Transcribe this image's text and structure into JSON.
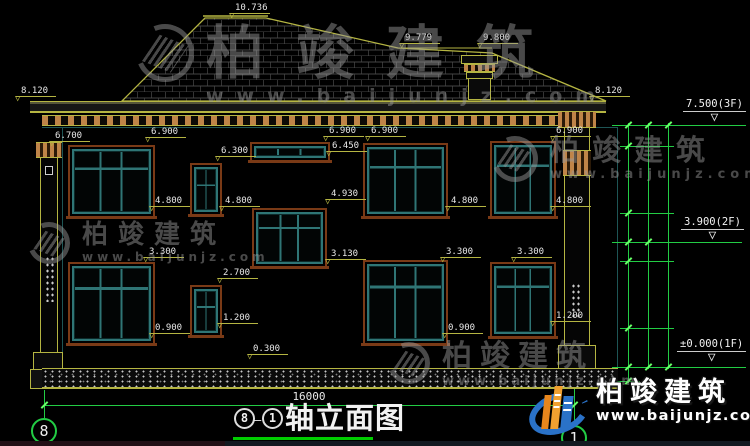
{
  "drawing": {
    "title_text": "轴立面图",
    "title_bubble_left": "8",
    "title_bubble_right": "1",
    "title_dash": "—",
    "overall_width_dim": "16000"
  },
  "axis_bubbles": {
    "left": "8",
    "right": "1"
  },
  "markers": [
    {
      "label": "10.736",
      "x": 230,
      "y": 3
    },
    {
      "label": "9.779",
      "x": 400,
      "y": 33
    },
    {
      "label": "9.800",
      "x": 478,
      "y": 33
    },
    {
      "label": "8.120",
      "x": 16,
      "y": 86
    },
    {
      "label": "8.120",
      "x": 590,
      "y": 86
    },
    {
      "label": "6.700",
      "x": 50,
      "y": 131
    },
    {
      "label": "6.900",
      "x": 146,
      "y": 127
    },
    {
      "label": "6.900",
      "x": 324,
      "y": 126
    },
    {
      "label": "6.450",
      "x": 327,
      "y": 141
    },
    {
      "label": "6.900",
      "x": 366,
      "y": 126
    },
    {
      "label": "6.900",
      "x": 551,
      "y": 126
    },
    {
      "label": "6.300",
      "x": 216,
      "y": 146
    },
    {
      "label": "4.930",
      "x": 326,
      "y": 189
    },
    {
      "label": "4.800",
      "x": 150,
      "y": 196
    },
    {
      "label": "4.800",
      "x": 220,
      "y": 196
    },
    {
      "label": "4.800",
      "x": 446,
      "y": 196
    },
    {
      "label": "4.800",
      "x": 551,
      "y": 196
    },
    {
      "label": "3.300",
      "x": 144,
      "y": 247
    },
    {
      "label": "3.300",
      "x": 441,
      "y": 247
    },
    {
      "label": "3.300",
      "x": 512,
      "y": 247
    },
    {
      "label": "3.130",
      "x": 326,
      "y": 249
    },
    {
      "label": "2.700",
      "x": 218,
      "y": 268
    },
    {
      "label": "1.200",
      "x": 218,
      "y": 313
    },
    {
      "label": "1.200",
      "x": 551,
      "y": 311
    },
    {
      "label": "0.900",
      "x": 150,
      "y": 323
    },
    {
      "label": "0.900",
      "x": 443,
      "y": 323
    },
    {
      "label": "0.300",
      "x": 248,
      "y": 344
    }
  ],
  "floor_markers": [
    {
      "label": "7.500(3F)",
      "x": 683,
      "y": 99
    },
    {
      "label": "3.900(2F)",
      "x": 681,
      "y": 217
    },
    {
      "label": "±0.000(1F)",
      "x": 677,
      "y": 339
    }
  ],
  "chain_dims": [
    {
      "label": "600",
      "x": 608,
      "y": 135
    },
    {
      "label": "2100",
      "x": 608,
      "y": 179
    },
    {
      "label": "900",
      "x": 608,
      "y": 227
    },
    {
      "label": "600",
      "x": 608,
      "y": 251
    },
    {
      "label": "2100",
      "x": 608,
      "y": 294
    },
    {
      "label": "1200",
      "x": 608,
      "y": 347
    },
    {
      "label": "450",
      "x": 616,
      "y": 372
    },
    {
      "label": "3600",
      "x": 629,
      "y": 183
    },
    {
      "label": "3900",
      "x": 629,
      "y": 303
    },
    {
      "label": "7500",
      "x": 650,
      "y": 268
    }
  ],
  "watermarks": [
    {
      "cls": "wm-a",
      "x": 136,
      "y": 24,
      "brand": "柏竣建筑",
      "url": "www.baijunjz.com"
    },
    {
      "cls": "wm-b",
      "x": 28,
      "y": 222,
      "brand": "柏竣建筑",
      "url": "www.baijunjz.com"
    },
    {
      "cls": "wm-c",
      "x": 492,
      "y": 136,
      "brand": "柏竣建筑",
      "url": "www.baijunjz.com"
    },
    {
      "cls": "wm-d",
      "x": 388,
      "y": 342,
      "brand": "柏竣建筑",
      "url": "www.baijunjz.com"
    }
  ],
  "logo": {
    "brand": "柏竣建筑",
    "url": "www.baijunjz.com"
  },
  "colors": {
    "line_yellow": "#b5b542",
    "line_green": "#22cc44",
    "tick_green": "#66ff66",
    "frame_brown": "#7a3a16",
    "frame_teal": "#2f7575",
    "dentil_tan": "#bf8448",
    "text_white": "#e8e8e8",
    "watermark_gray": "#9a9a9a",
    "logo_blue": "#2a72c8",
    "logo_orange": "#f0a030"
  }
}
